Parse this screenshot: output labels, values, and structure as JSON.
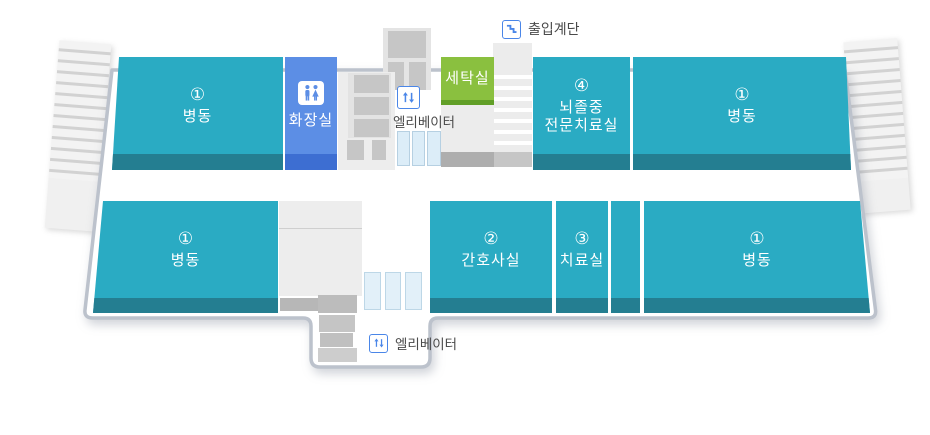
{
  "colors": {
    "teal": "#2aabc3",
    "teal_dark": "#247e91",
    "blue": "#5c8ee5",
    "blue_dark": "#3d6ed2",
    "green": "#8ac03f",
    "green_dark": "#619f27",
    "outline": "#bcc2cc",
    "icon_blue": "#4a86e8",
    "label_text": "#4a4a4a"
  },
  "legend": {
    "entry_stairs": {
      "label": "출입계단",
      "icon": "stairs-icon"
    },
    "elevator_top": {
      "label": "엘리베이터",
      "icon": "elevator-arrows-icon"
    },
    "elevator_bottom": {
      "label": "엘리베이터",
      "icon": "elevator-arrows-icon"
    }
  },
  "rooms": {
    "ward_top_left": {
      "number": "①",
      "name": "병동"
    },
    "restroom": {
      "name": "화장실",
      "icon": "restroom-icon"
    },
    "laundry": {
      "name": "세탁실"
    },
    "stroke_unit": {
      "number": "④",
      "name_line1": "뇌졸중",
      "name_line2": "전문치료실"
    },
    "ward_top_right": {
      "number": "①",
      "name": "병동"
    },
    "ward_bottom_left": {
      "number": "①",
      "name": "병동"
    },
    "nurse_station": {
      "number": "②",
      "name": "간호사실"
    },
    "treatment_room": {
      "number": "③",
      "name": "치료실"
    },
    "ward_bottom_right": {
      "number": "①",
      "name": "병동"
    }
  }
}
